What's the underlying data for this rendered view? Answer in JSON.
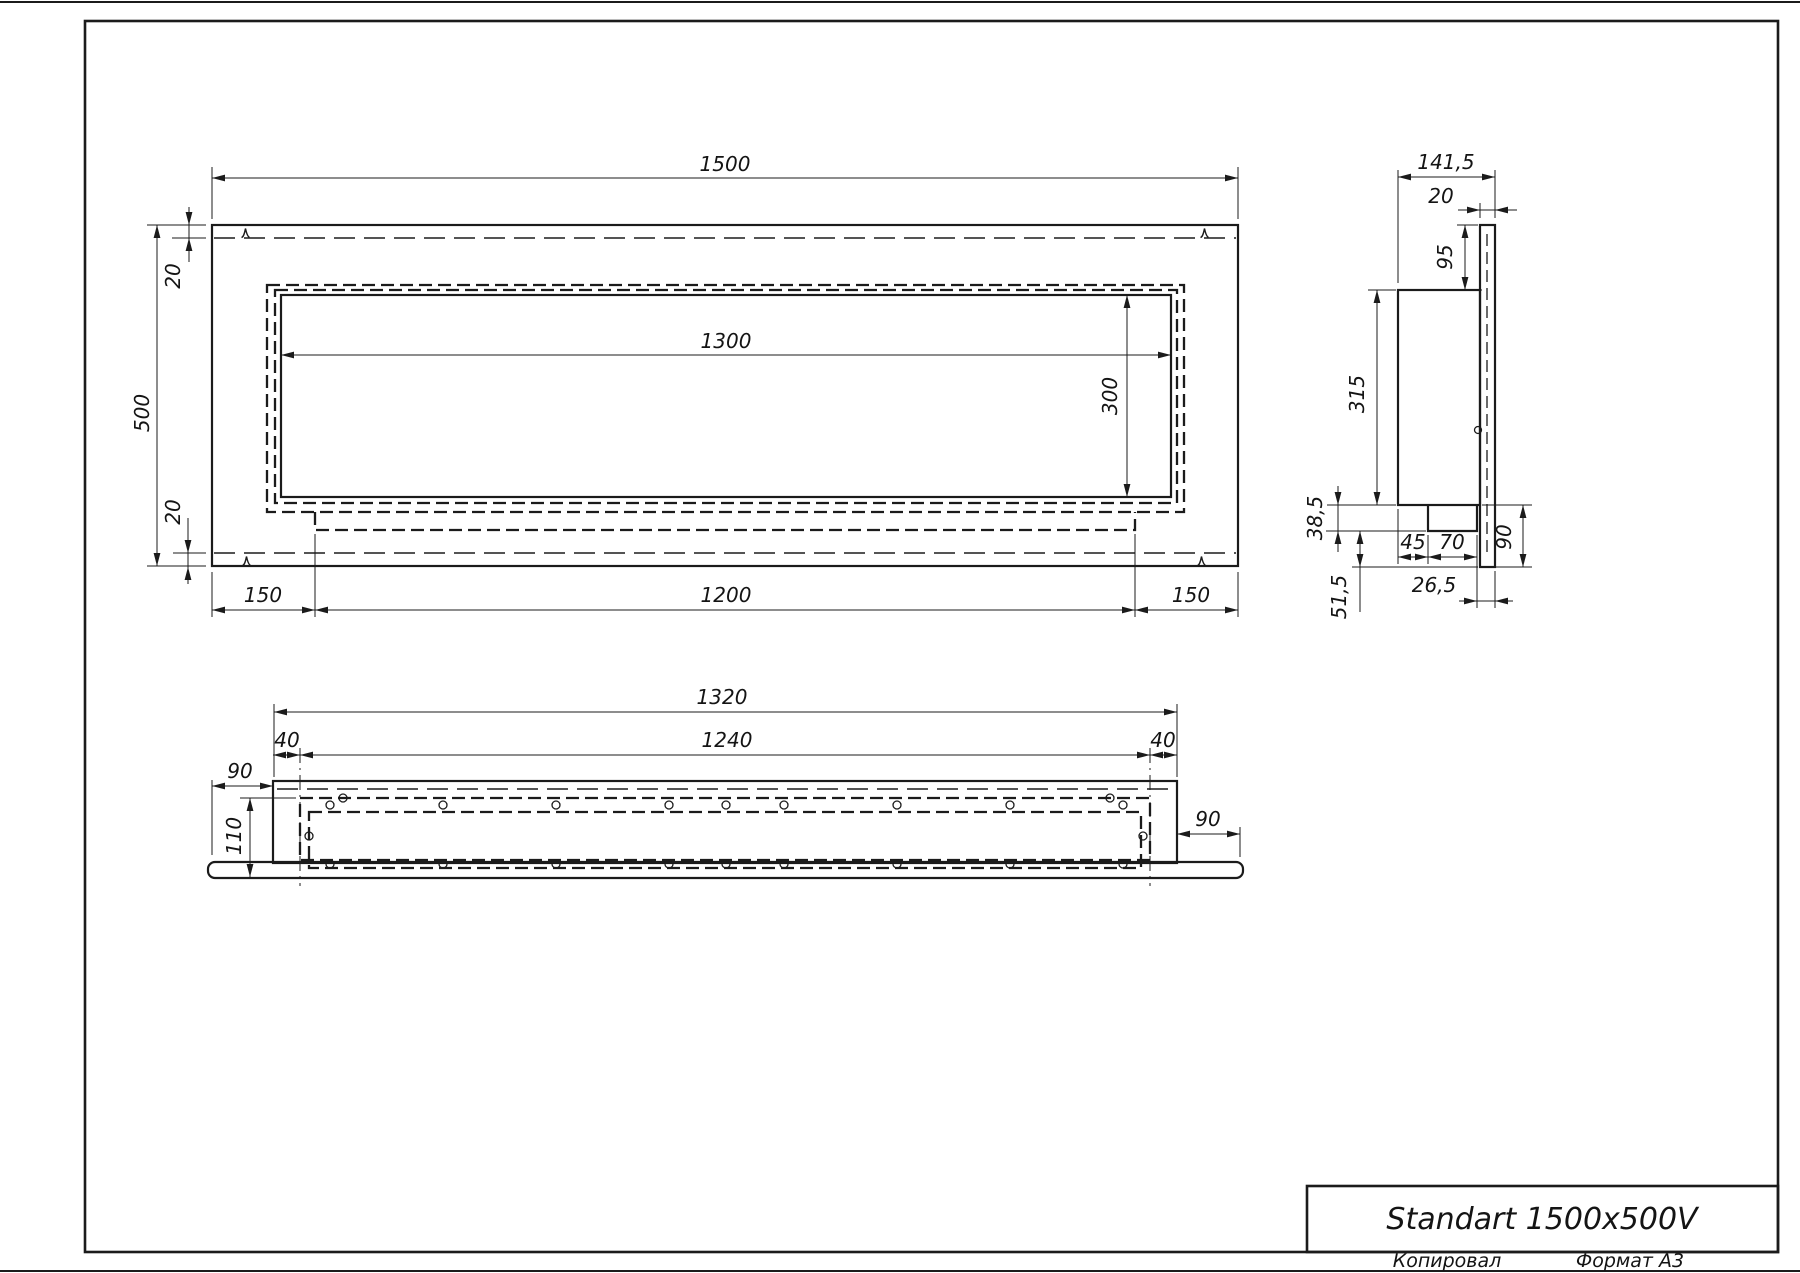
{
  "colors": {
    "ink": "#1b1b1b",
    "paper": "#ffffff"
  },
  "title_block": {
    "model": "Standart 1500x500V"
  },
  "footer": {
    "copied": "Копировал",
    "format": "Формат А3"
  },
  "views": {
    "front": {
      "width": "1500",
      "height": "500",
      "top_inset": "20",
      "bottom_inset": "20",
      "opening_width": "1300",
      "opening_height": "300",
      "left_margin": "150",
      "bottom_span": "1200",
      "right_margin": "150"
    },
    "plan": {
      "outer_width": "1320",
      "inner_span": "1240",
      "left_inset": "40",
      "right_inset": "40",
      "left_overhang": "90",
      "depth": "110",
      "right_overhang": "90"
    },
    "side": {
      "total_depth": "141,5",
      "fascia_thickness": "20",
      "top_offset": "95",
      "body_height": "315",
      "tray_height": "38,5",
      "front_inset": "45",
      "tray_width": "70",
      "rear_inset": "26,5",
      "lower_height": "90",
      "lower_offset": "51,5"
    }
  }
}
